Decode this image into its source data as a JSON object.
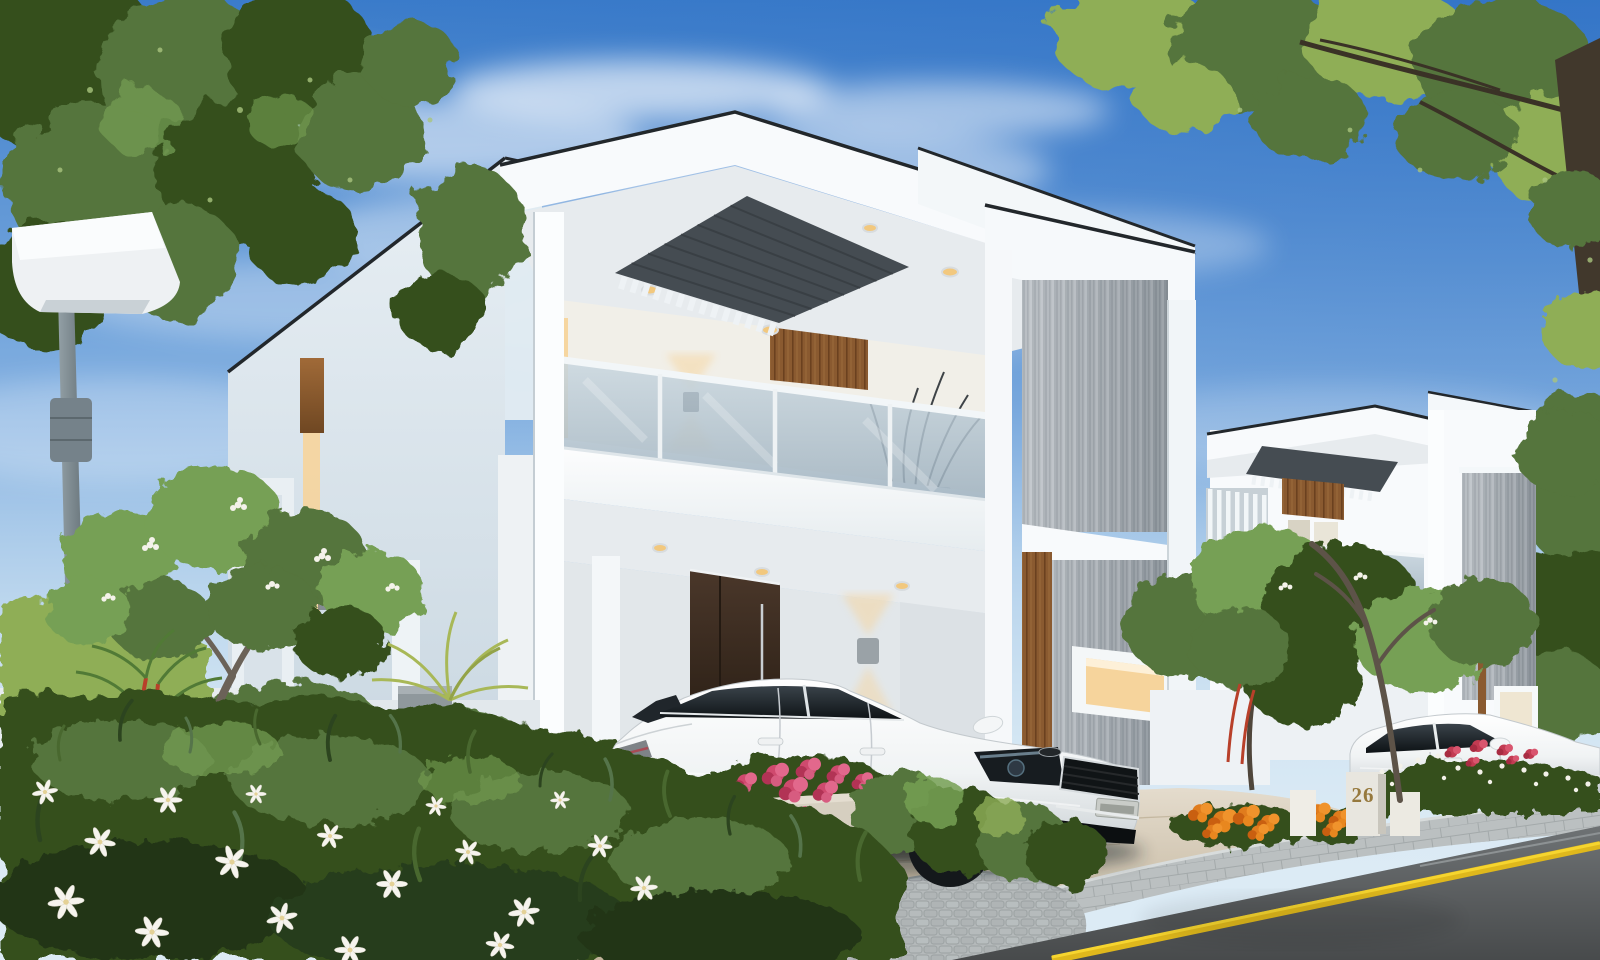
{
  "scene": {
    "description": "Daytime 3D architectural rendering of a modern two-storey white villa with covered carport, glass-railed balcony and dark louvred pergola ceiling; a white sedan is parked in the driveway, a matching villa with a second white sedan stands beyond, surrounded by plumeria trees, shrubs, white lilies, pink and orange flowers, a street lamp, paved sidewalk and asphalt road with a yellow edge line under a blue sky with clouds",
    "house_number_label": "26"
  },
  "palette": {
    "sky_top": "#3b7cca",
    "sky_horizon": "#dcebf5",
    "cloud_white": "#ffffff",
    "villa_white": "#f8fafc",
    "villa_shade": "#d9e3ea",
    "soffit_gray": "#e7ebee",
    "trim_dark": "#22272b",
    "pergola_slate": "#454c52",
    "wood_accent": "#8a5a30",
    "door_brown": "#3a2b20",
    "glass_blue": "#b5c4cf",
    "concrete_gray": "#a7aeb4",
    "warm_light": "#f6d49c",
    "foliage_dark": "#35501f",
    "foliage_mid": "#55743c",
    "foliage_light": "#76a054",
    "foliage_yellow": "#8fae57",
    "flower_white": "#f6f4ee",
    "flower_pink": "#cf4a6e",
    "flower_red": "#c23b52",
    "flower_orange": "#e07c1d",
    "car_white": "#f2f4f5",
    "car_glass": "#20262b",
    "road_asphalt": "#6e7274",
    "road_line_yellow": "#e9c120",
    "driveway_beige": "#d6c9b2",
    "sidewalk_gray": "#bbc0c1",
    "cobble_gray": "#b4b9ba",
    "lamp_gray": "#7d8a90",
    "gold_number": "#96793e"
  },
  "objects": {
    "buildings": [
      "main modern white villa",
      "neighbouring white villa"
    ],
    "vehicles": [
      "white sedan in driveway",
      "white sedan at neighbouring villa"
    ],
    "vegetation": [
      "overhanging tree canopies",
      "plumeria trees",
      "garden shrubs and hedges",
      "white lily flowers",
      "pink planter flowers",
      "orange marigold flowers",
      "red flower bed"
    ],
    "street": [
      "street lamp",
      "paved sidewalk",
      "asphalt road",
      "yellow road edge line",
      "block-paved driveway",
      "cobblestone apron"
    ],
    "architecture": [
      "louvred pergola ceiling",
      "glass balcony railing",
      "concrete feature wall",
      "timber entry door",
      "wall sconce lights",
      "recessed ceiling lights",
      "house number plinth"
    ]
  }
}
